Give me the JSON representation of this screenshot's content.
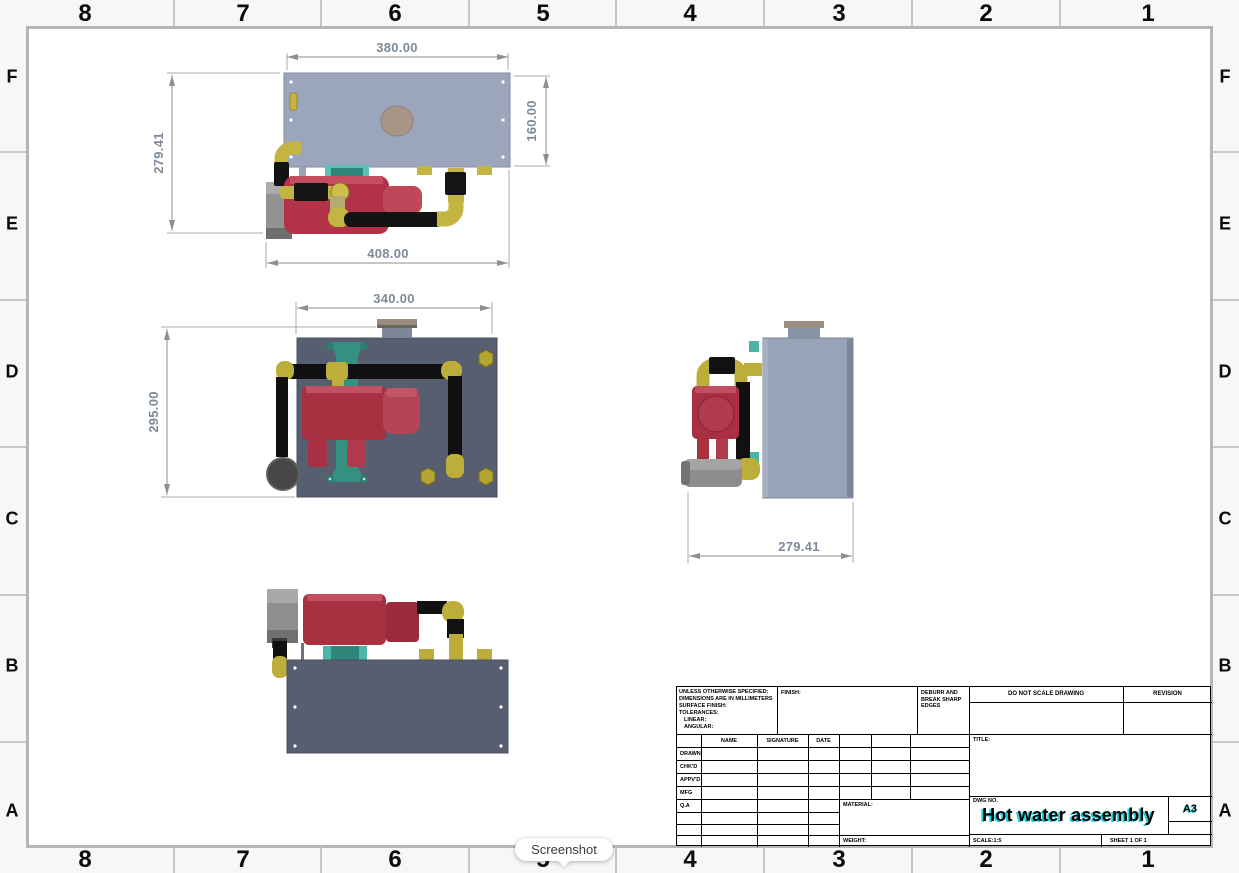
{
  "sheet": {
    "zone_columns": [
      "8",
      "7",
      "6",
      "5",
      "4",
      "3",
      "2",
      "1"
    ],
    "zone_rows": [
      "F",
      "E",
      "D",
      "C",
      "B",
      "A"
    ]
  },
  "tooltip": {
    "label": "Screenshot"
  },
  "drawing": {
    "views": {
      "top": {
        "dim_width_plate": "380.00",
        "dim_depth_plate": "160.00",
        "dim_depth_overall": "279.41",
        "dim_width_overall": "408.00"
      },
      "front": {
        "dim_width": "340.00",
        "dim_height": "295.00"
      },
      "side": {
        "dim_depth": "279.41"
      }
    }
  },
  "title_block": {
    "spec_lines": [
      "UNLESS OTHERWISE SPECIFIED:",
      "DIMENSIONS ARE IN MILLIMETERS",
      "SURFACE FINISH:",
      "TOLERANCES:",
      "LINEAR:",
      "ANGULAR:"
    ],
    "finish_label": "FINISH:",
    "deburr_note": "DEBURR AND BREAK SHARP EDGES",
    "do_not_scale_note": "DO NOT SCALE DRAWING",
    "revision_label": "REVISION",
    "col_name": "NAME",
    "col_signature": "SIGNATURE",
    "col_date": "DATE",
    "approval_rows": [
      "DRAWN",
      "CHK'D",
      "APPV'D",
      "MFG",
      "Q.A"
    ],
    "material_label": "MATERIAL:",
    "weight_label": "WEIGHT:",
    "title_label": "TITLE:",
    "dwg_no_label": "DWG NO.",
    "drawing_title": "Hot water assembly",
    "paper_size": "A3",
    "scale_label": "SCALE:1:5",
    "sheet_label": "SHEET 1 OF 1"
  },
  "colors": {
    "tank_plate_light": "#9ba5bb",
    "plate_dark": "#565e6f",
    "pump_red": "#a93041",
    "fitting_yellow": "#bdae3b",
    "pipe_black": "#131313",
    "bracket_teal": "#2f8579",
    "cap_tan": "#a79588",
    "dimension_text": "#7f8a99",
    "title_highlight_cyan": "#1fd4e0"
  }
}
